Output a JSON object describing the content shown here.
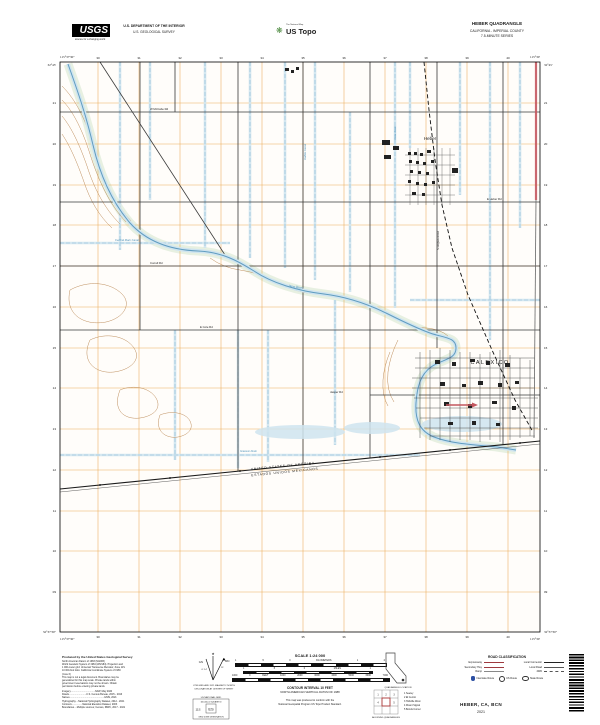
{
  "header": {
    "usgs": {
      "wordmark": "USGS",
      "tagline": "science for a changing world"
    },
    "department_line1": "U.S. DEPARTMENT OF THE INTERIOR",
    "department_line2": "U.S. GEOLOGICAL SURVEY",
    "ustopo": {
      "program": "The National Map",
      "brand": "US Topo",
      "icon": "❋"
    },
    "title": {
      "quadrangle": "HEBER QUADRANGLE",
      "state_county": "CALIFORNIA - IMPERIAL COUNTY",
      "series": "7.5-MINUTE SERIES"
    }
  },
  "colors": {
    "grid_orange": "#e8a347",
    "water_line": "#8fbdd8",
    "water_fill": "#cfe4ef",
    "contour_brown": "#b5804a",
    "highway_red": "#c4565e",
    "interstate_blue": "#2b4ea2",
    "legend_red": "#9e3a3f"
  },
  "map": {
    "place_labels": {
      "town": "Heber",
      "city": "CALEXICO",
      "river": "New River",
      "border_line1": "UNITED STATES OF AMERICA",
      "border_line2": "ESTADOS UNIDOS MEXICANOS",
      "canal1": "Central Main Canal",
      "canal2": "Dahlia Canal",
      "canal3": "Rose Drain",
      "canal4": "Greeson Drain",
      "road1": "W McCabe Rd",
      "road2": "E Heber Rd",
      "road3": "Correll Rd",
      "road4": "E Cole Rd",
      "road5": "Jasper Rd",
      "road6": "S Dogwood Rd"
    },
    "corners": {
      "tl_lat": "32°45'",
      "tl_lon": "115°37'30\"",
      "tr_lat": "32°45'",
      "tr_lon": "115°30'",
      "bl_lat": "32°37'30\"",
      "bl_lon": "115°37'30\"",
      "br_lat": "32°37'30\"",
      "br_lon": "115°30'"
    },
    "ticks": {
      "top": [
        "30",
        "31",
        "32",
        "33",
        "34",
        "35",
        "36",
        "37",
        "38",
        "39",
        "40"
      ],
      "bottom": [
        "30",
        "31",
        "32",
        "33",
        "34",
        "35",
        "36",
        "37",
        "38",
        "39",
        "40"
      ],
      "left": [
        "21",
        "20",
        "19",
        "18",
        "17",
        "16",
        "15",
        "14",
        "13",
        "12",
        "11",
        "10",
        "09"
      ],
      "right": [
        "21",
        "20",
        "19",
        "18",
        "17",
        "16",
        "15",
        "14",
        "13",
        "12",
        "11",
        "10",
        "09"
      ]
    }
  },
  "footer": {
    "produced": {
      "title": "Produced by the United States Geological Survey",
      "body": "North American Datum of 1983 (NAD83)\nWorld Geodetic System of 1984 (WGS84). Projection and\n1 000-meter grid: Universal Transverse Mercator, Zone 11S\n10 000-foot ticks: California Coordinate System of 1983\n(zone 6)\nThis map is not a legal document. Boundaries may be\ngeneralized for this map scale. Private lands within\ngovernment reservations may not be shown. Obtain\npermission before entering private lands.",
      "sources": "Imagery.....................................NAIP, May 2020\nRoads..........................U.S. Census Bureau, 2015 - 2016\nNames....................................................GNIS, 2021\nHydrography....National Hydrography Dataset, 2012 - 2021\nContours................National Elevation Dataset, 2003\nBoundaries....Multiple sources; Census, IBWC, 2017 - 2021"
    },
    "declination": {
      "star": "★",
      "gn_label": "GN",
      "mn_label": "MN",
      "gn_value": "0° 14'",
      "mn_value": "11°",
      "caption_line1": "UTM GRID AND 2021 MAGNETIC NORTH",
      "caption_line2": "DECLINATION AT CENTER OF SHEET"
    },
    "usng": {
      "line1": "US NATIONAL GRID",
      "line2": "100,000-m SQUARE ID",
      "square_id": "ES",
      "zone": "11S",
      "caption": "GRID ZONE DESIGNATION"
    },
    "scale": {
      "title": "SCALE 1:24 000",
      "km_labels": [
        "1",
        ".5",
        "0",
        "KILOMETERS",
        "1",
        "2"
      ],
      "mi_labels": [
        "1",
        ".5",
        "0",
        "MILES",
        "1"
      ],
      "ft_labels": [
        "1000",
        "0",
        "FEET",
        "1000",
        "2000",
        "3000",
        "4000",
        "5000",
        "6000",
        "7000"
      ],
      "contour_note": "CONTOUR INTERVAL 10 FEET",
      "datum_note": "NORTH AMERICAN VERTICAL DATUM OF 1988",
      "standard_line1": "This map was produced to conform with the",
      "standard_line2": "National Geospatial Program US Topo Product Standard."
    },
    "inset": {
      "caption": "QUADRANGLE LOCATION"
    },
    "adjoining": {
      "caption": "ADJOINING QUADRANGLES",
      "cell_numbers": [
        "1",
        "2",
        "3",
        "4",
        "5"
      ],
      "quads": [
        "1 Seeley",
        "2 El Centro",
        "3 Holtville West",
        "4 Mount Signal",
        "5 Bonds Corner"
      ]
    },
    "roads": {
      "title": "ROAD CLASSIFICATION",
      "left": [
        {
          "label": "Expressway"
        },
        {
          "label": "Secondary Hwy"
        },
        {
          "label": "Ramp"
        }
      ],
      "right": [
        {
          "label": "Local Connector"
        },
        {
          "label": "Local Road"
        },
        {
          "label": "4WD"
        }
      ],
      "shields": [
        {
          "label": "Interstate Route"
        },
        {
          "label": "US Route"
        },
        {
          "label": "State Route"
        }
      ]
    },
    "sheet": {
      "name": "HEBER, CA, BCN",
      "year": "2021"
    }
  }
}
